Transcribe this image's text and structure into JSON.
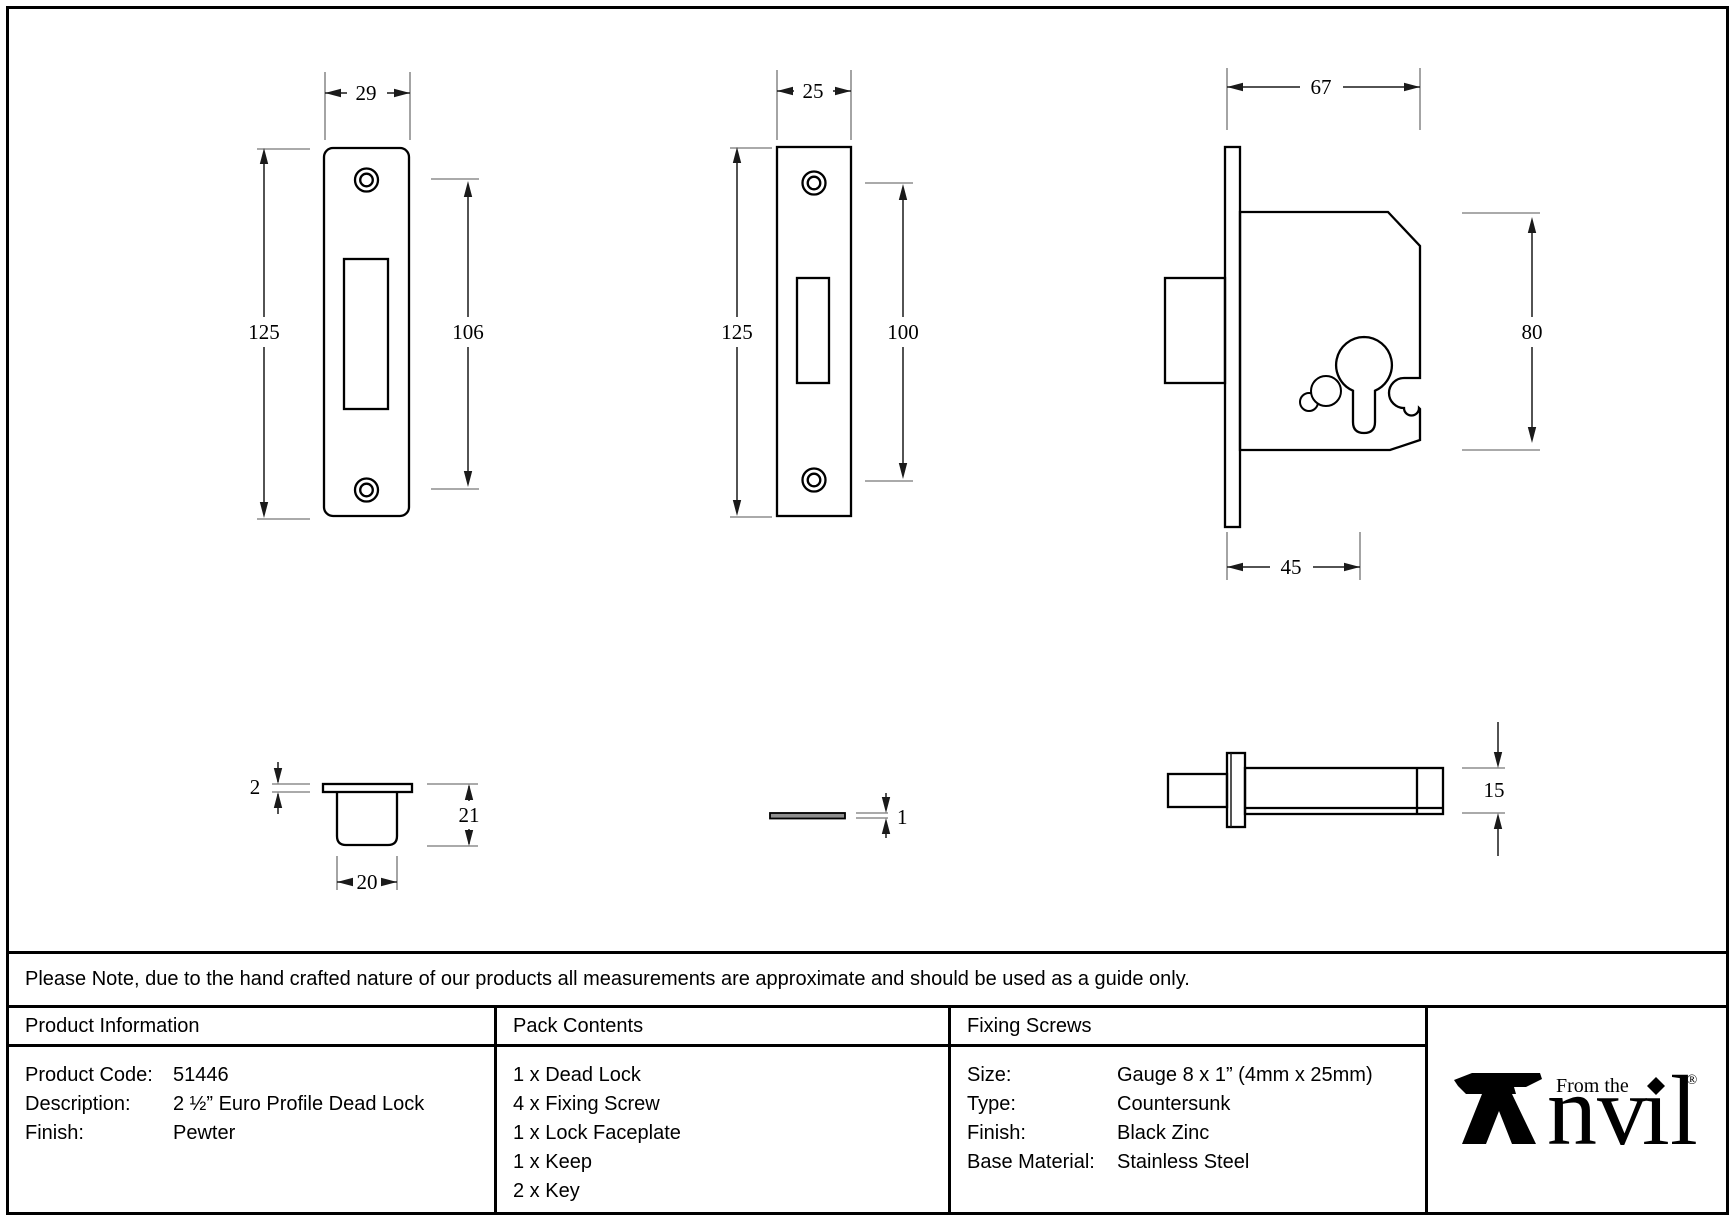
{
  "note": "Please Note, due to the hand crafted nature of our products all measurements are approximate and should be used as a guide only.",
  "drawings": {
    "keep_front": {
      "width": "29",
      "height": "125",
      "hole_spacing": "106"
    },
    "lock_faceplate_front": {
      "width": "25",
      "height": "125",
      "hole_spacing": "100"
    },
    "lock_body_side": {
      "depth": "67",
      "height": "80",
      "backset": "45"
    },
    "keep_side": {
      "plate_thickness": "2",
      "box_depth": "21",
      "box_width": "20"
    },
    "faceplate_side": {
      "thickness": "1"
    },
    "lock_body_edge": {
      "height": "15"
    }
  },
  "table": {
    "product_information": {
      "header": "Product Information",
      "rows": [
        {
          "label": "Product Code:",
          "value": "51446"
        },
        {
          "label": "Description:",
          "value": "2 ½” Euro Profile Dead Lock"
        },
        {
          "label": "Finish:",
          "value": "Pewter"
        }
      ]
    },
    "pack_contents": {
      "header": "Pack Contents",
      "items": [
        "1 x Dead Lock",
        "4 x Fixing Screw",
        "1 x Lock Faceplate",
        "1 x Keep",
        "2 x Key"
      ]
    },
    "fixing_screws": {
      "header": "Fixing Screws",
      "rows": [
        {
          "label": "Size:",
          "value": "Gauge 8 x 1” (4mm x 25mm)"
        },
        {
          "label": "Type:",
          "value": "Countersunk"
        },
        {
          "label": "Finish:",
          "value": "Black Zinc"
        },
        {
          "label": "Base Material:",
          "value": "Stainless Steel"
        }
      ]
    }
  },
  "brand": {
    "tagline": "From the",
    "name": "Anvil",
    "name_nv": "nv",
    "name_i": "ı",
    "name_l": "l",
    "registered": "®"
  }
}
